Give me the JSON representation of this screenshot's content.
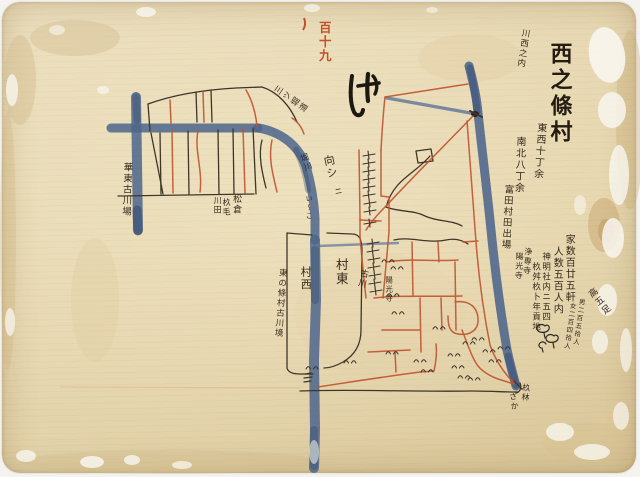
{
  "folio": {
    "number_red": "百十九"
  },
  "title_block": {
    "region": "川西之内",
    "village_name": "西之條村",
    "extent_east_west": "東西十丁余",
    "extent_north_south": "南北八丁余"
  },
  "census": {
    "houses": "家数百廿五軒",
    "population": "人数五百人内",
    "male": "男二百五拾人",
    "female": "女二百四拾人",
    "yield_note": "高五足"
  },
  "notes": {
    "shrine_1": "神明社内ニ五四",
    "shrine_2": "杦舛杦⼘年貢地",
    "temple_josenji": "浄専寺",
    "temple_yokoji": "陽光寺"
  },
  "map_labels": {
    "tomita_field": "富田村田出場",
    "old_river_bank": "華東古川場",
    "east_village_boundary": "東の條村古川境",
    "village_east": "村東",
    "village_west": "村西",
    "old_river": "古川",
    "temple_site": "陽光寺",
    "matsukura": "松倉",
    "sugike": "杦毛",
    "kawada": "川田",
    "mitsubori_road": "三ツ堀道",
    "mukai": "向シ",
    "mukai_ni": "ニ",
    "horikawa": "堀川",
    "iriko": "い〜こ",
    "grove": "杦林",
    "saka": "さか"
  },
  "colors": {
    "paper": "#e6d7b2",
    "ink_black": "#3f362a",
    "ink_red": "#c0532f",
    "river_blue": "#4c658c",
    "folio_red": "#c4502a"
  }
}
